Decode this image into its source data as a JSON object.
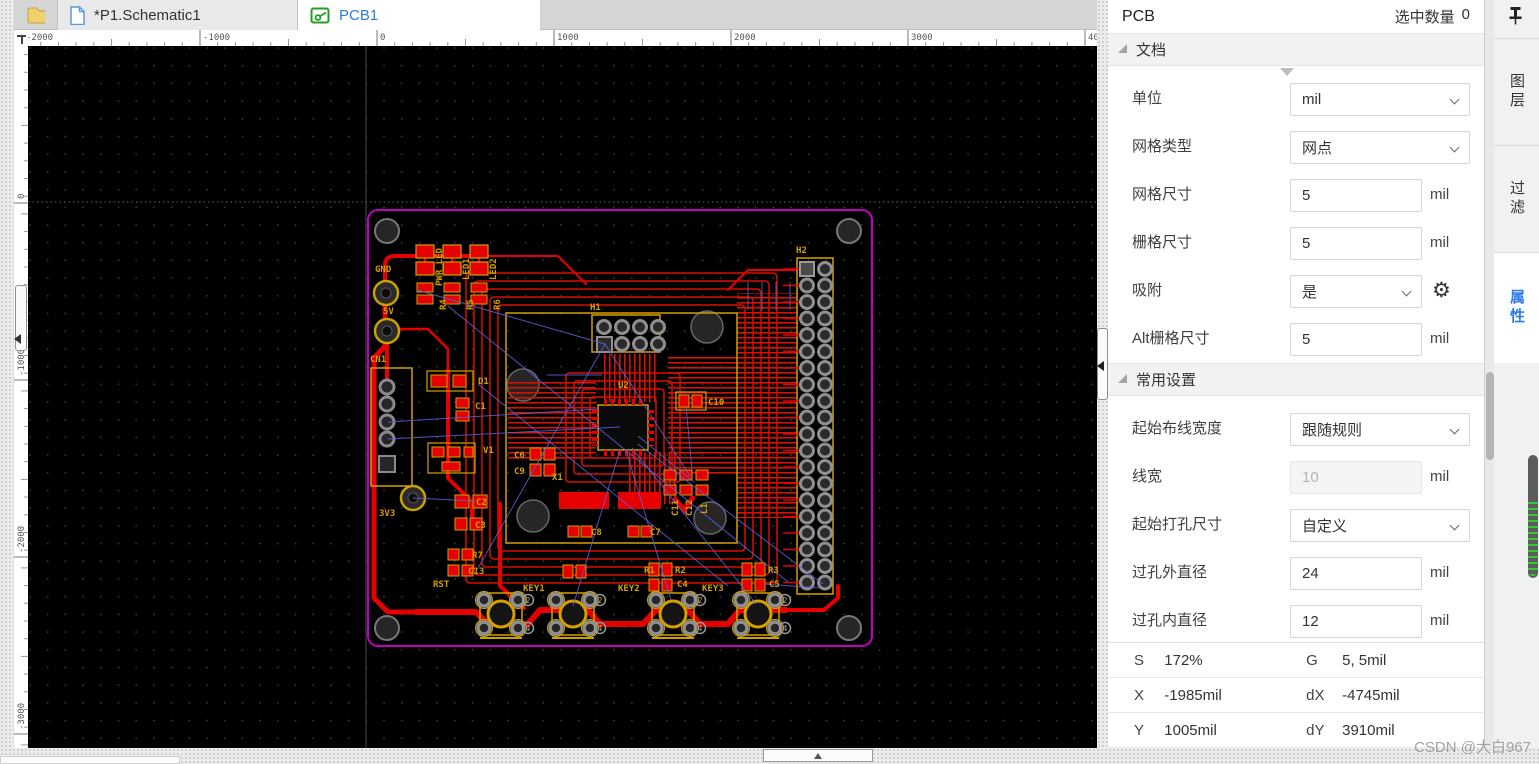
{
  "tab_bar": {
    "schematic": "*P1.Schematic1",
    "pcb": "PCB1"
  },
  "rulers": {
    "top": [
      "-2000",
      "-1000",
      "0",
      "1000",
      "2000",
      "3000",
      "4000"
    ],
    "left": [
      "0",
      "-1000",
      "-2000",
      "-3000"
    ]
  },
  "canvas": {
    "background": "#000000",
    "board_outline_color": "#c000c0",
    "trace_color": "#e60000",
    "silkscreen_color": "#d4a000",
    "ratsnest_color": "#6060e0",
    "silkscreen": [
      [
        "GND",
        347,
        226,
        0
      ],
      [
        "5V",
        355,
        268,
        0
      ],
      [
        "CN1",
        342,
        316,
        0
      ],
      [
        "3V3",
        351,
        470,
        0
      ],
      [
        "D1",
        450,
        338,
        0
      ],
      [
        "V1",
        455,
        407,
        0
      ],
      [
        "C1",
        447,
        363,
        0
      ],
      [
        "C2",
        448,
        459,
        0
      ],
      [
        "C3",
        447,
        482,
        0
      ],
      [
        "R7",
        444,
        512,
        0
      ],
      [
        "C13",
        440,
        528,
        0
      ],
      [
        "RST",
        405,
        541,
        0
      ],
      [
        "KEY1",
        495,
        545,
        0
      ],
      [
        "KEY2",
        590,
        545,
        0
      ],
      [
        "KEY3",
        674,
        545,
        0
      ],
      [
        "R1",
        616,
        527,
        0
      ],
      [
        "R2",
        647,
        527,
        0
      ],
      [
        "C4",
        649,
        541,
        0
      ],
      [
        "R3",
        740,
        527,
        0
      ],
      [
        "C5",
        741,
        541,
        0
      ],
      [
        "C6",
        486,
        412,
        0
      ],
      [
        "C9",
        486,
        428,
        0
      ],
      [
        "X1",
        524,
        434,
        0
      ],
      [
        "C8",
        563,
        489,
        0
      ],
      [
        "C7",
        622,
        489,
        0
      ],
      [
        "C10",
        680,
        359,
        0
      ],
      [
        "U2",
        590,
        342,
        0
      ],
      [
        "H1",
        562,
        264,
        0
      ],
      [
        "H2",
        768,
        207,
        0
      ],
      [
        "PWR_LED",
        414,
        240,
        -90
      ],
      [
        "LED1",
        441,
        234,
        -90
      ],
      [
        "LED2",
        468,
        234,
        -90
      ],
      [
        "R4",
        418,
        264,
        -90
      ],
      [
        "R5",
        445,
        264,
        -90
      ],
      [
        "R6",
        472,
        264,
        -90
      ],
      [
        "C11",
        650,
        470,
        -90
      ],
      [
        "C12",
        664,
        470,
        -90
      ],
      [
        "L1",
        679,
        468,
        -90
      ]
    ],
    "keys": [
      {
        "label": "RST",
        "x": 473
      },
      {
        "label": "KEY1",
        "x": 545
      },
      {
        "label": "KEY2",
        "x": 645
      },
      {
        "label": "KEY3",
        "x": 730
      }
    ],
    "key_pad_numbers": [
      "2",
      "4"
    ]
  },
  "right_panel": {
    "title": "PCB",
    "selected_label": "选中数量",
    "selected_count": "0",
    "sections": [
      {
        "title": "文档",
        "rows": [
          {
            "name": "unit",
            "label": "单位",
            "type": "select",
            "value": "mil"
          },
          {
            "name": "grid-type",
            "label": "网格类型",
            "type": "select",
            "value": "网点"
          },
          {
            "name": "grid-size",
            "label": "网格尺寸",
            "type": "input",
            "value": "5",
            "unit": "mil"
          },
          {
            "name": "snap-size",
            "label": "栅格尺寸",
            "type": "input",
            "value": "5",
            "unit": "mil"
          },
          {
            "name": "snap",
            "label": "吸附",
            "type": "select",
            "value": "是",
            "gear": true,
            "narrow": true
          },
          {
            "name": "alt-grid-size",
            "label": "Alt栅格尺寸",
            "type": "input",
            "value": "5",
            "unit": "mil"
          }
        ]
      },
      {
        "title": "常用设置",
        "rows": [
          {
            "name": "route-width-mode",
            "label": "起始布线宽度",
            "type": "select",
            "value": "跟随规则"
          },
          {
            "name": "line-width",
            "label": "线宽",
            "type": "input",
            "value": "10",
            "unit": "mil",
            "disabled": true
          },
          {
            "name": "via-size-mode",
            "label": "起始打孔尺寸",
            "type": "select",
            "value": "自定义"
          },
          {
            "name": "via-outer-diameter",
            "label": "过孔外直径",
            "type": "input",
            "value": "24",
            "unit": "mil"
          },
          {
            "name": "via-inner-diameter",
            "label": "过孔内直径",
            "type": "input",
            "value": "12",
            "unit": "mil"
          }
        ]
      }
    ],
    "status": [
      [
        "S",
        "172%",
        "G",
        "5, 5mil"
      ],
      [
        "X",
        "-1985mil",
        "dX",
        "-4745mil"
      ],
      [
        "Y",
        "1005mil",
        "dY",
        "3910mil"
      ]
    ]
  },
  "side_tabs": {
    "layers": "图层",
    "filter": "过滤",
    "properties": "属性"
  },
  "watermark": "CSDN @大白967",
  "colors": {
    "accent": "#2b7ce9",
    "tab_active_text": "#2a7de1",
    "pcb_icon_green": "#22a022"
  }
}
